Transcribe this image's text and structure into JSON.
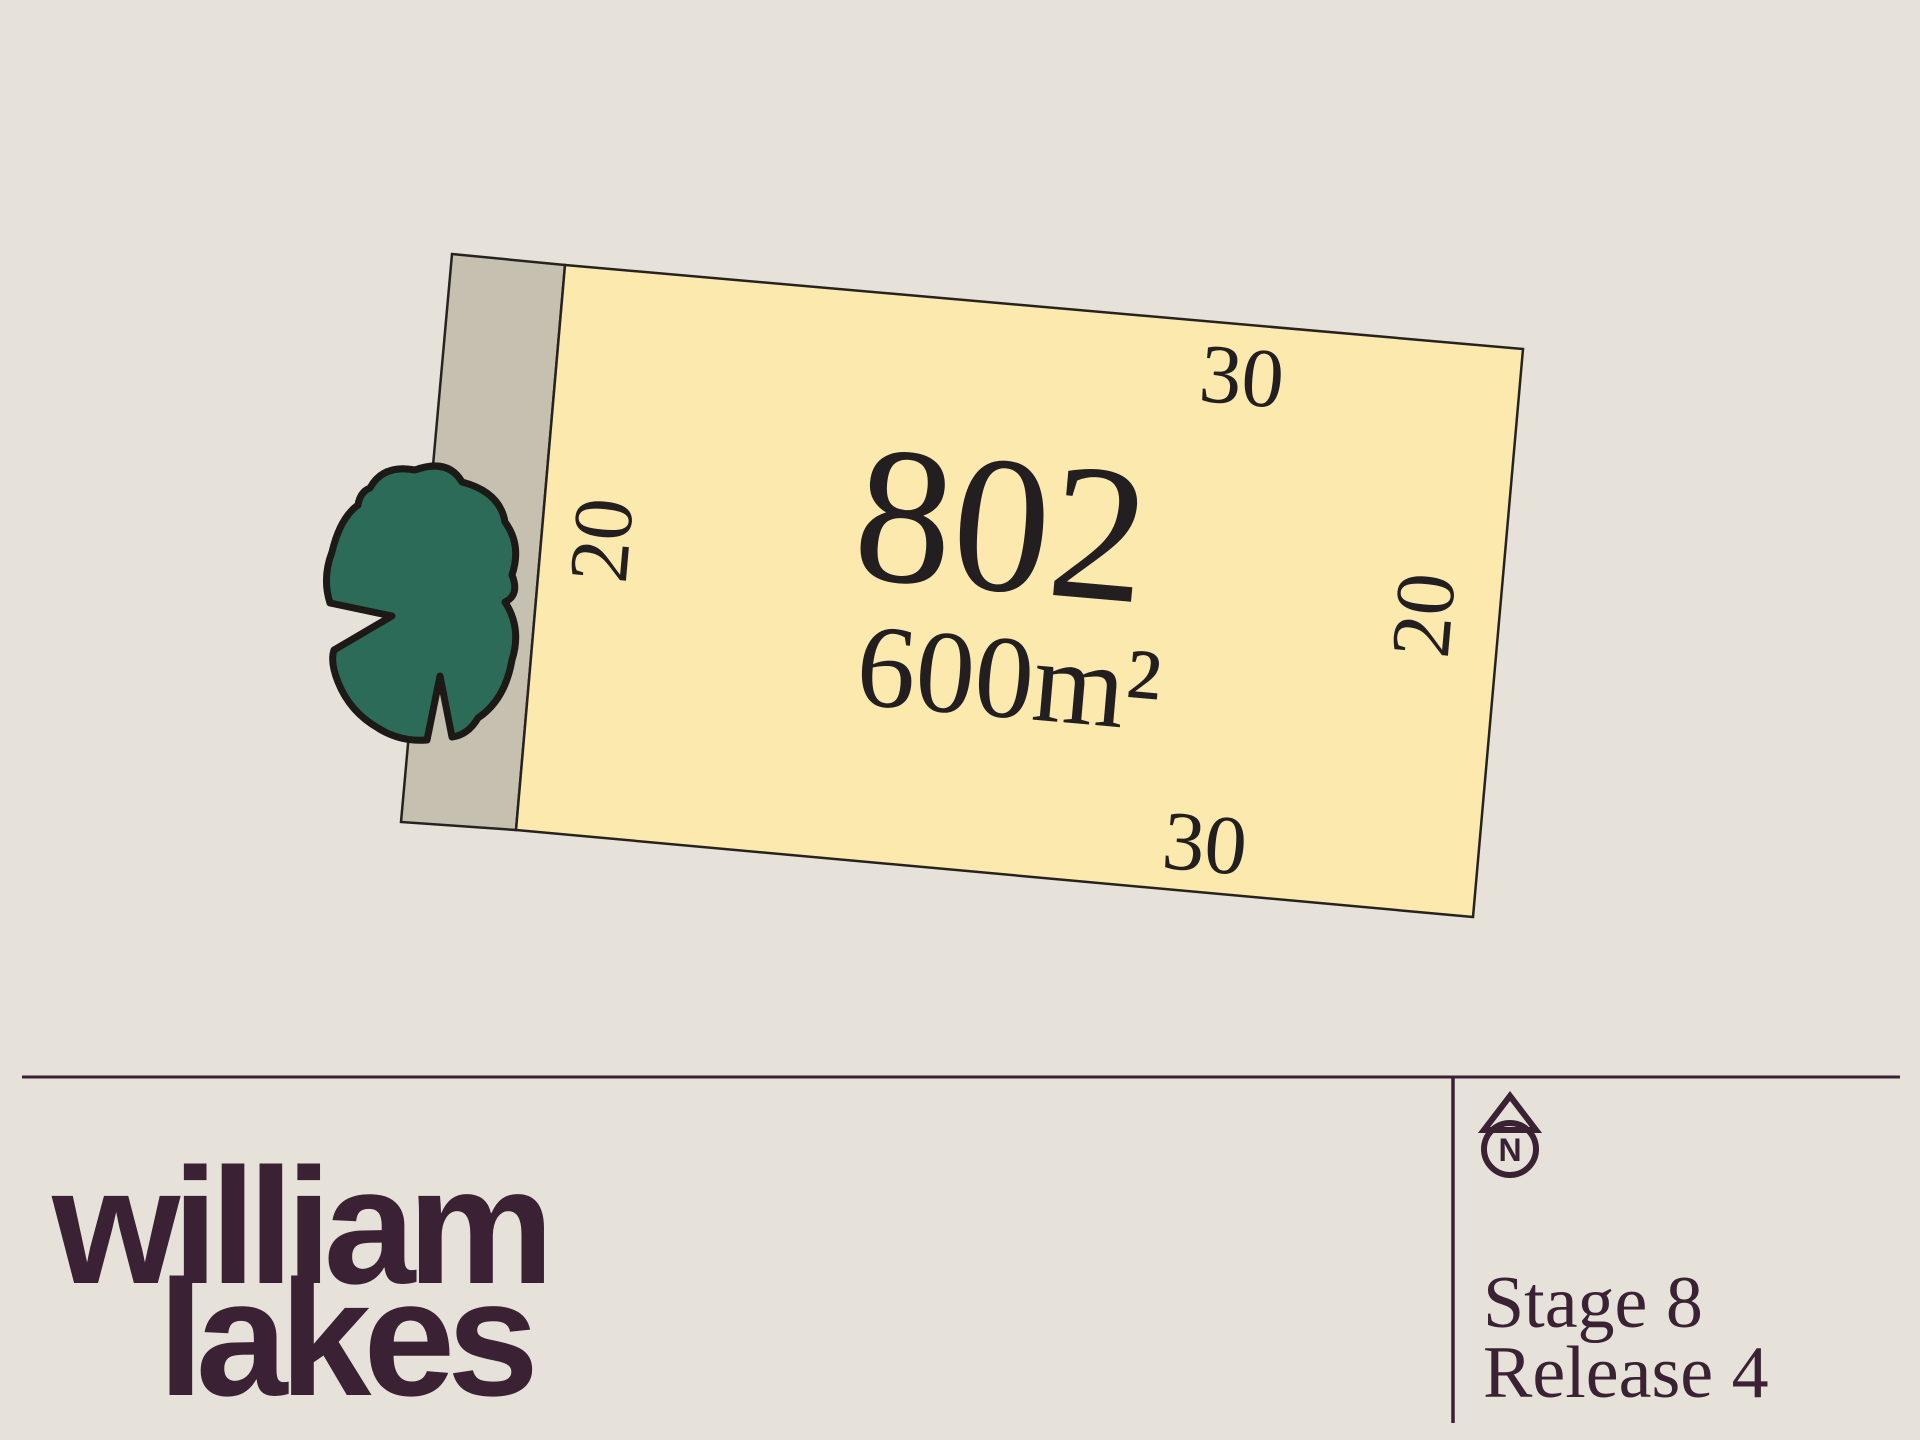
{
  "plan": {
    "lot_number": "802",
    "area": "600m²",
    "dimensions": {
      "top": "30",
      "bottom": "30",
      "left": "20",
      "right": "20"
    },
    "icons": {
      "tree": "tree-canopy-icon",
      "north": "north-compass-icon"
    }
  },
  "footer": {
    "logo_line1": "william",
    "logo_line2": "lakes",
    "stage": "Stage 8",
    "release": "Release 4",
    "north_label": "N"
  },
  "colors": {
    "background": "#e6e2d9",
    "lot_fill": "#fce9ae",
    "strip_fill": "#c5c0af",
    "outline": "#26221f",
    "tree_fill": "#2d6b59",
    "accent_plum": "#3a2133"
  }
}
